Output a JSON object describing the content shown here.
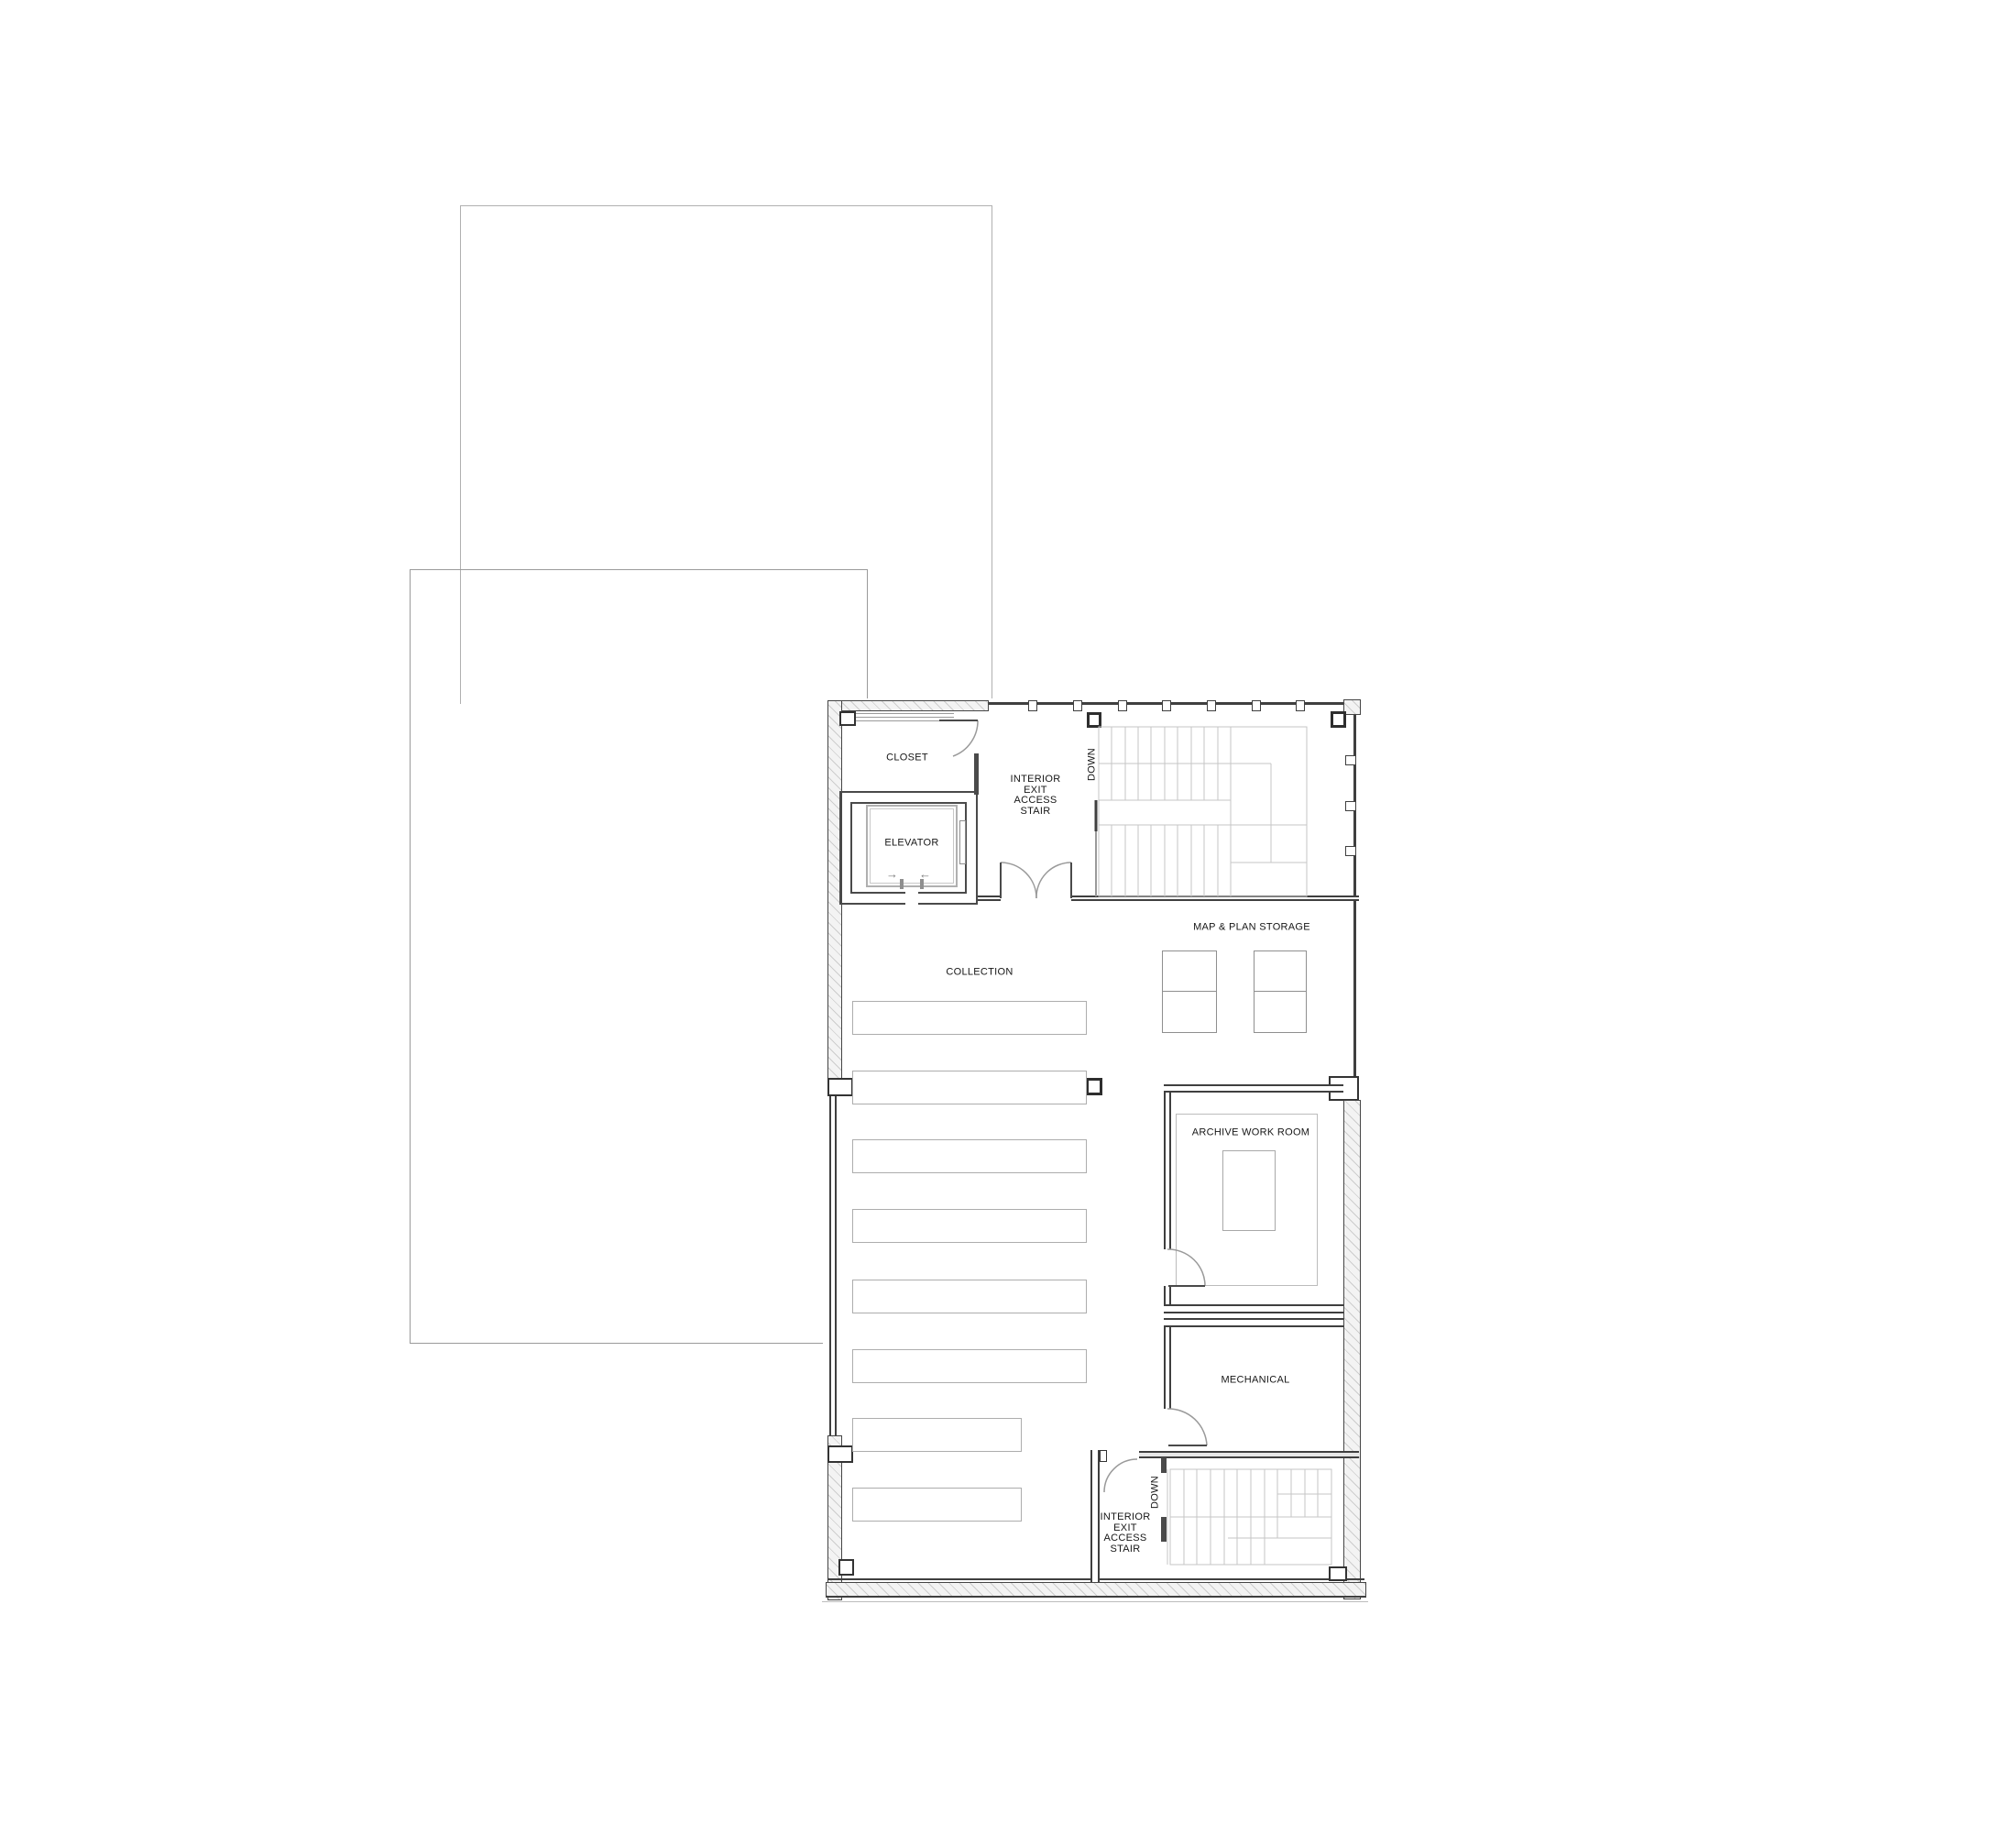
{
  "drawing": {
    "type": "architectural floor plan",
    "colors": {
      "background": "#ffffff",
      "wall_line": "#3f3f3f",
      "medium_line": "#8f8f8f",
      "light_line": "#c6c6c6",
      "hatch_fill": "#f3f3f3",
      "text": "#161616"
    },
    "rooms": {
      "closet": {
        "label": "CLOSET"
      },
      "elevator": {
        "label": "ELEVATOR",
        "door_arrows": {
          "in": "→",
          "out": "←"
        }
      },
      "stair_top": {
        "lines": [
          "INTERIOR",
          "EXIT",
          "ACCESS",
          "STAIR"
        ],
        "down": "DOWN"
      },
      "map_plan_storage": {
        "label": "MAP & PLAN STORAGE",
        "flat_file_units": 2
      },
      "collection": {
        "label": "COLLECTION",
        "shelving_rows": 8
      },
      "archive_work_room": {
        "label": "ARCHIVE WORK ROOM"
      },
      "mechanical": {
        "label": "MECHANICAL"
      },
      "stair_bottom": {
        "lines": [
          "INTERIOR",
          "EXIT",
          "ACCESS",
          "STAIR"
        ],
        "down": "DOWN"
      }
    }
  }
}
